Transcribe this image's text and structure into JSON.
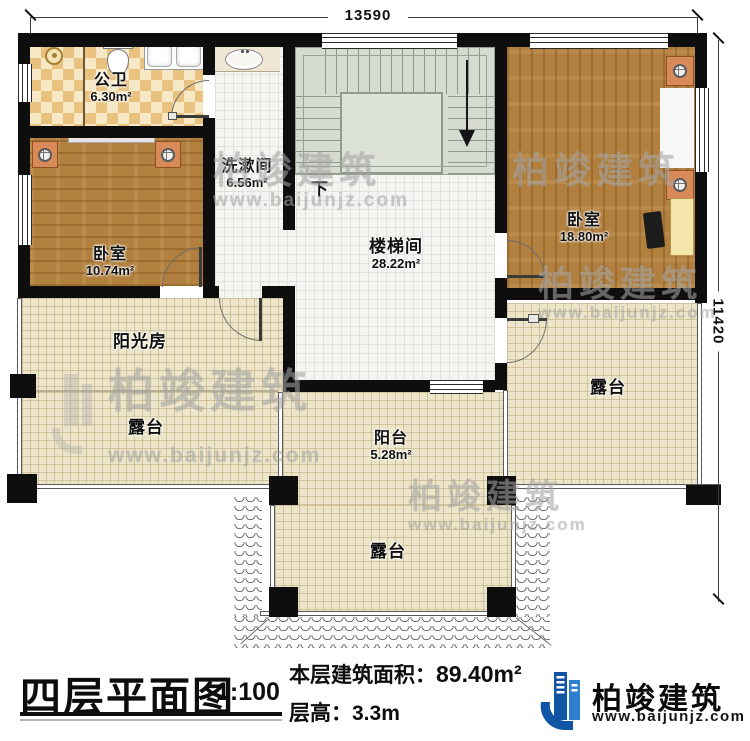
{
  "dimensions": {
    "width_label": "13590",
    "height_label": "11420"
  },
  "rooms": {
    "bathroom": {
      "name": "公卫",
      "area": "6.30m²"
    },
    "washroom": {
      "name": "洗漱间",
      "area": "6.56m²"
    },
    "bedroom_left": {
      "name": "卧室",
      "area": "10.74m²"
    },
    "bedroom_right": {
      "name": "卧室",
      "area": "18.80m²"
    },
    "stair_hall": {
      "name": "楼梯间",
      "area": "28.22m²"
    },
    "sunroom": {
      "name": "阳光房"
    },
    "balcony": {
      "name": "阳台",
      "area": "5.28m²"
    },
    "terrace_left": {
      "name": "露台"
    },
    "terrace_right": {
      "name": "露台"
    },
    "terrace_bottom": {
      "name": "露台"
    }
  },
  "stairs": {
    "direction_label": "下"
  },
  "watermark": {
    "brand": "柏竣建筑",
    "site": "www.baijunjz.com"
  },
  "footer": {
    "plan_title": "四层平面图",
    "scale": "1:100",
    "area_label": "本层建筑面积：",
    "area_value": "89.40m²",
    "floor_height": "层高：3.3m",
    "brand_name": "柏竣建筑",
    "brand_site": "www.baijunjz.com"
  },
  "colors": {
    "wall": "#0e0e0e",
    "wood_floor": "#b2803e",
    "bed_blue": "#76bfd7",
    "terrace_cream": "#ede5c9",
    "logo_blue": "#1054a4",
    "logo_blue_light": "#2e7ecd"
  }
}
